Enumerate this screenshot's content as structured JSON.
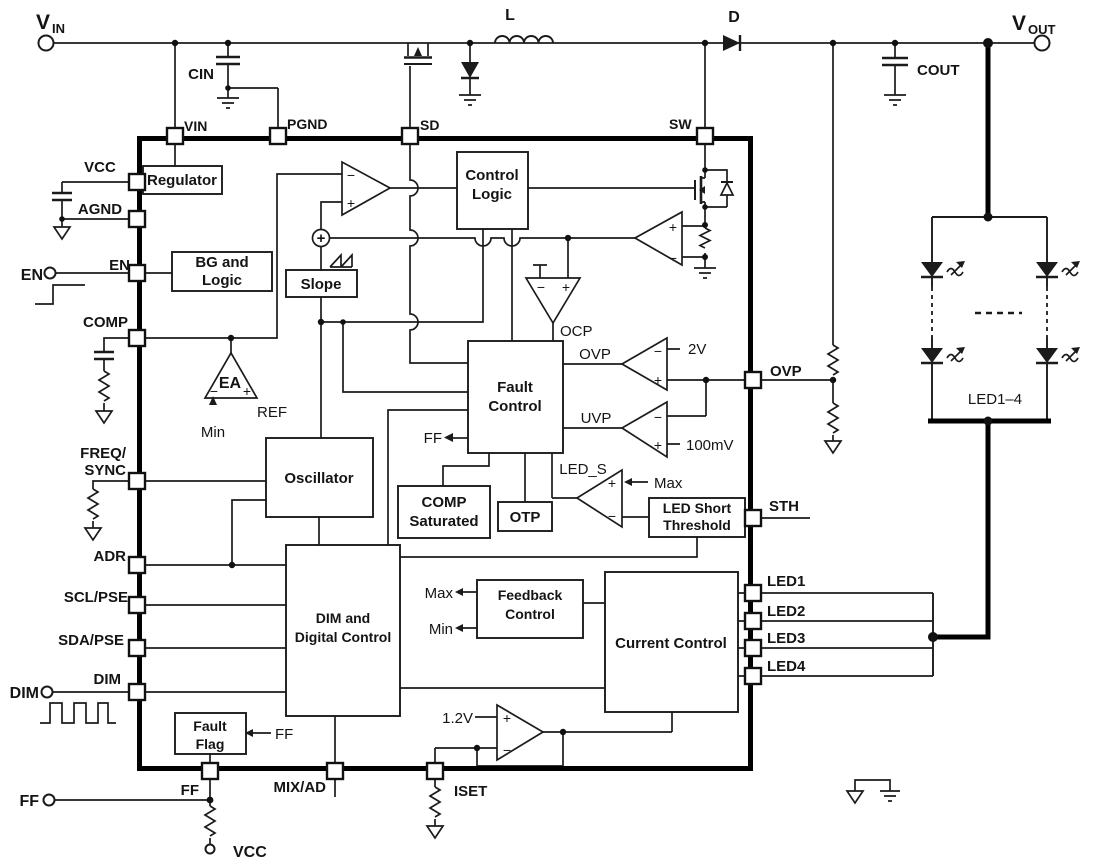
{
  "title": "Boost LED driver IC functional block diagram",
  "colors": {
    "ink": "#1b1b1b",
    "thick_bus": "#000000",
    "background": "#ffffff"
  },
  "labels": {
    "vin_v": "V",
    "vin_sub": "IN",
    "vout_v": "V",
    "vout_sub": "OUT",
    "cin": "CIN",
    "cout": "COUT",
    "inductor": "L",
    "diode": "D",
    "pin_vin": "VIN",
    "pin_pgnd": "PGND",
    "pin_sd": "SD",
    "pin_sw": "SW",
    "pin_vcc": "VCC",
    "pin_agnd": "AGND",
    "pin_en": "EN",
    "pin_comp": "COMP",
    "pin_freq": "FREQ/",
    "pin_sync": "SYNC",
    "pin_adr": "ADR",
    "pin_scl": "SCL/PSE",
    "pin_sda": "SDA/PSE",
    "pin_dim": "DIM",
    "pin_ovp": "OVP",
    "pin_sth": "STH",
    "pin_led1": "LED1",
    "pin_led2": "LED2",
    "pin_led3": "LED3",
    "pin_led4": "LED4",
    "pin_ff": "FF",
    "pin_mixad": "MIX/AD",
    "pin_iset": "ISET",
    "term_en": "EN",
    "term_dim": "DIM",
    "term_ff": "FF",
    "term_vcc": "VCC",
    "blk_regulator": "Regulator",
    "blk_bg1": "BG and",
    "blk_bg2": "Logic",
    "blk_slope": "Slope",
    "blk_ctl1": "Control",
    "blk_ctl2": "Logic",
    "blk_fault1": "Fault",
    "blk_fault2": "Control",
    "blk_osc": "Oscillator",
    "blk_cs1": "COMP",
    "blk_cs2": "Saturated",
    "blk_otp": "OTP",
    "blk_lst1": "LED Short",
    "blk_lst2": "Threshold",
    "blk_dim1": "DIM and",
    "blk_dim2": "Digital Control",
    "blk_fb1": "Feedback",
    "blk_fb2": "Control",
    "blk_cc": "Current Control",
    "blk_flag1": "Fault",
    "blk_flag2": "Flag",
    "ea": "EA",
    "min": "Min",
    "ref": "REF",
    "ocp": "OCP",
    "ovp_sig": "OVP",
    "uvp_sig": "UVP",
    "v2": "2V",
    "mv100": "100mV",
    "v12": "1.2V",
    "led_s": "LED_S",
    "max_led": "Max",
    "max_fb": "Max",
    "min_fb": "Min",
    "ff_fc": "FF",
    "ff_flag": "FF",
    "led_string": "LED1–4",
    "plus": "+",
    "minus": "−"
  }
}
